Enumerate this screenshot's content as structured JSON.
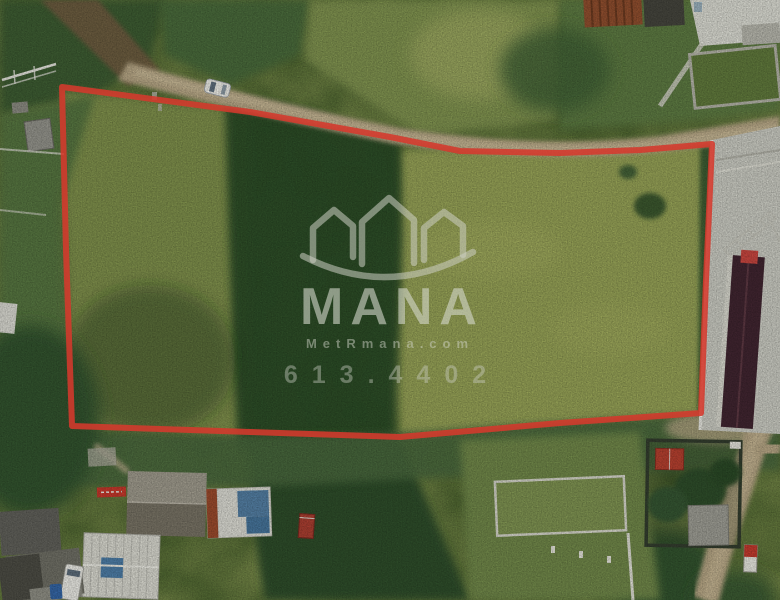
{
  "meta": {
    "type": "aerial-drone-photograph",
    "subject": "vacant grassy land parcel for sale outlined in red, surrounded by dirt roads, trees and small houses",
    "width": 780,
    "height": 600
  },
  "watermark": {
    "brand": "MANA",
    "website": "MetRmana.com",
    "phone": "613.4402",
    "logo": "three-house-rooftops-over-arc",
    "color": "#ced0c4"
  },
  "plot_outline": {
    "color": "#d5392c",
    "stroke_width": 6,
    "points": "62,87 250,112 390,137 460,151 560,153 640,150 712,144 706,280 701,413 560,423 400,437 250,432 72,426 66,250"
  },
  "scene": {
    "terrain": "grass field with dark tree clusters",
    "palette": {
      "grass_light": "#95a156",
      "grass_olive": "#7e8f4c",
      "trees_dark": "#2c4b28",
      "road_tan": "#b5a584",
      "concrete": "#c9cac1",
      "maroon_roof": "#402530"
    },
    "objects": [
      "dirt-road-across-top",
      "white-car-on-road",
      "dark-tree-strip-inside-plot",
      "concrete-yard-right",
      "maroon-roof-building-right",
      "crane-truss-right",
      "rusty-metal-roof-top",
      "walled-garden-top-right",
      "houses-bottom-left",
      "white-metal-roof-house",
      "blue-patched-roof-house",
      "red-sign-on-roof",
      "white-van-bottom-left",
      "white-outlined-plot-bottom",
      "red-roof-shed-bottom-right",
      "dirt-road-bottom-right",
      "red-white-post-bottom-right"
    ]
  }
}
